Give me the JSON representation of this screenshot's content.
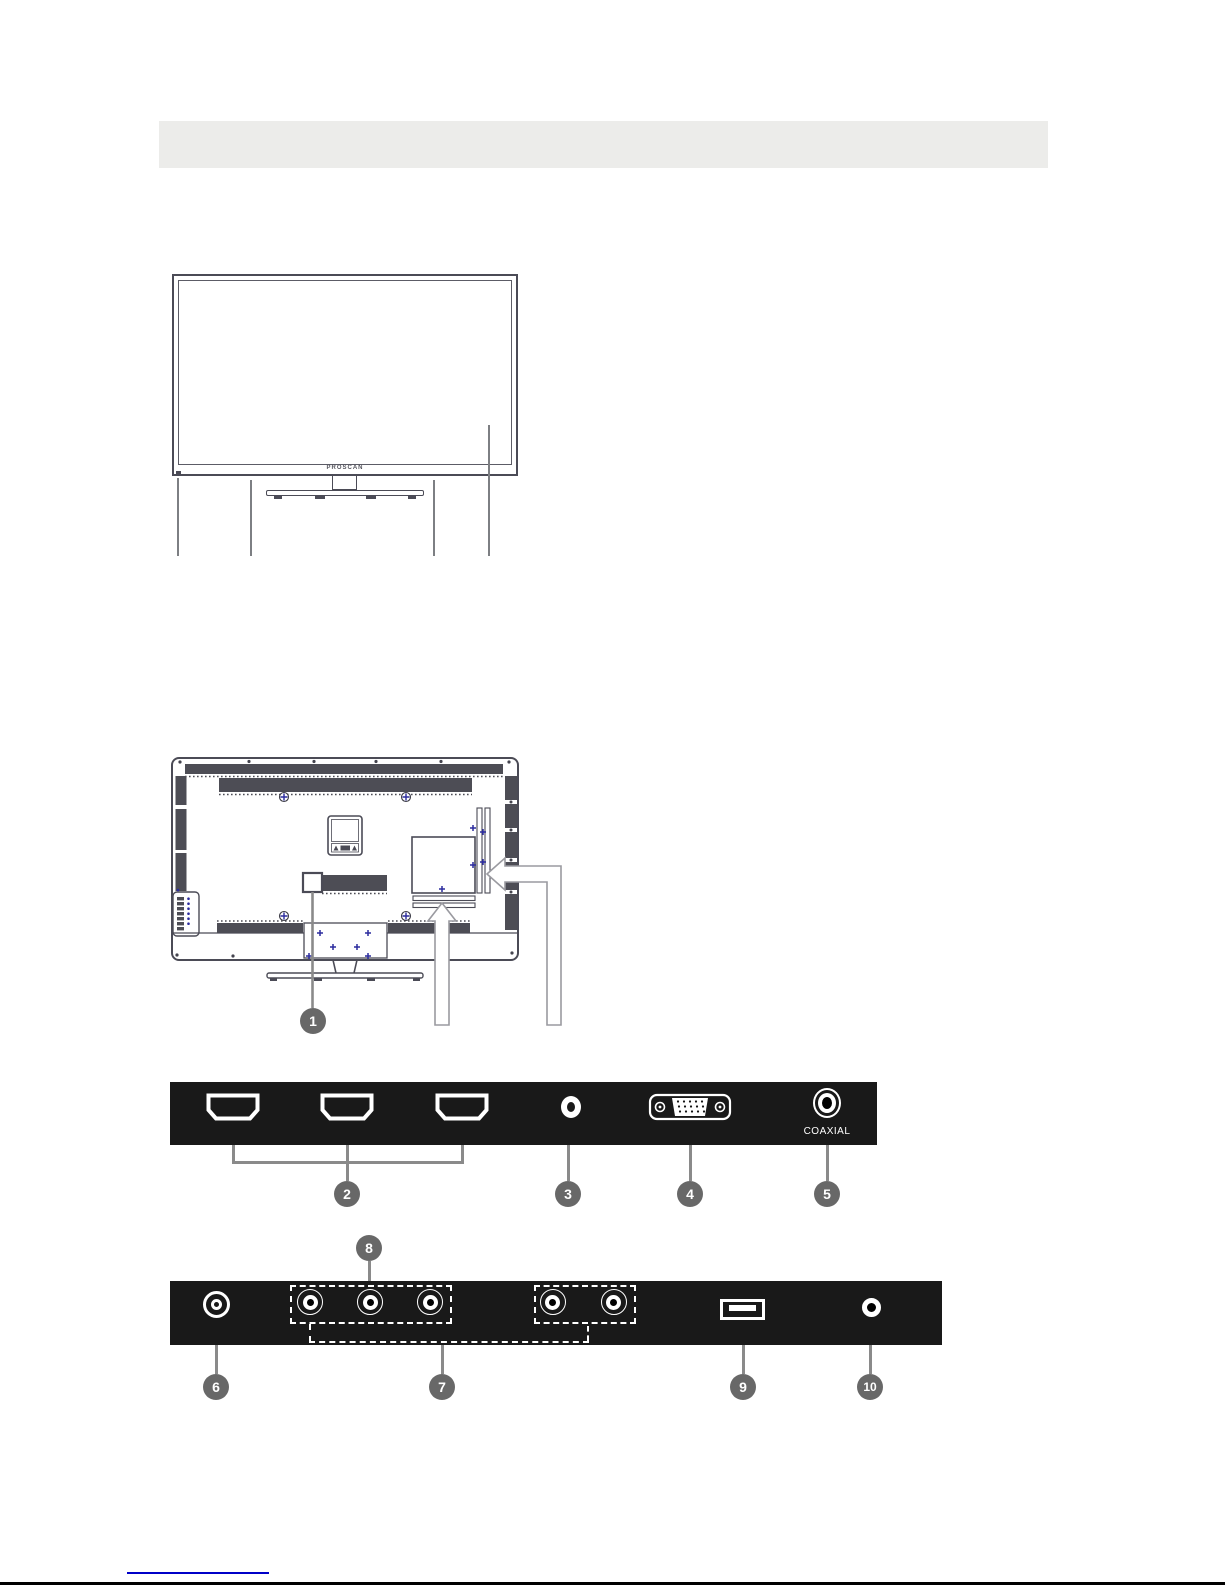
{
  "front_view": {
    "brand_label": "PROSCAN"
  },
  "rear_view": {
    "callout_power": "1"
  },
  "io_panel_top": {
    "coaxial_label": "COAXIAL",
    "ports": [
      "hdmi-port",
      "hdmi-port",
      "hdmi-port",
      "av-input-jack",
      "vga-port",
      "coaxial-port"
    ],
    "callouts": {
      "hdmi_group": "2",
      "av_jack": "3",
      "vga": "4",
      "coaxial": "5"
    }
  },
  "io_panel_bottom": {
    "ports": [
      "antenna-port",
      "rca-jack",
      "rca-jack",
      "rca-jack",
      "rca-jack",
      "rca-jack",
      "usb-port",
      "headphone-jack"
    ],
    "callouts": {
      "antenna": "6",
      "av_group": "7",
      "component_group": "8",
      "usb": "9",
      "headphone": "10"
    }
  },
  "colors": {
    "header_bar": "#ececea",
    "panel_background": "#191919",
    "callout_circle": "#686868",
    "leader_line": "#8a8a8a",
    "line_art": "#4b4b56",
    "vent_fill": "#4d4d55",
    "screw_blue": "#2b2b9e",
    "footer_link": "#0000c8",
    "page_edge": "#000000"
  }
}
